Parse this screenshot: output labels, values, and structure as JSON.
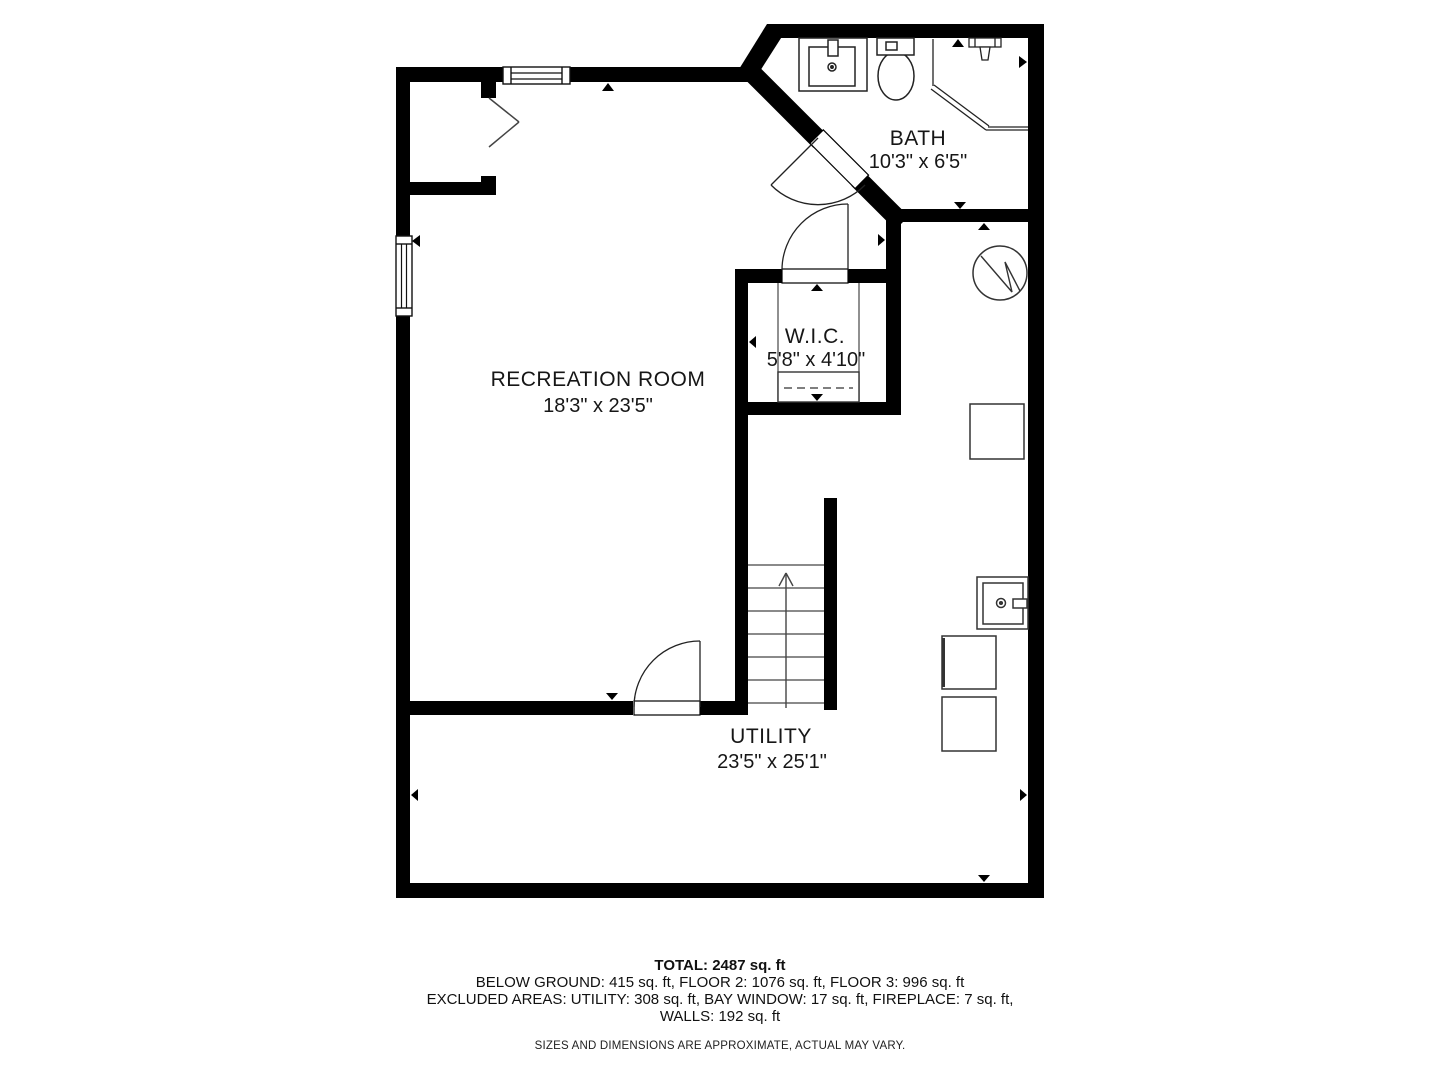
{
  "rooms": {
    "bath": {
      "name": "BATH",
      "dimensions": "10'3\" x 6'5\""
    },
    "wic": {
      "name": "W.I.C.",
      "dimensions": "5'8\" x 4'10\""
    },
    "recreation": {
      "name": "RECREATION ROOM",
      "dimensions": "18'3\" x 23'5\""
    },
    "utility": {
      "name": "UTILITY",
      "dimensions": "23'5\" x 25'1\""
    }
  },
  "fixtures": [
    "sink-vanity-icon",
    "toilet-icon",
    "shower-icon",
    "water-heater-icon",
    "appliance-icon",
    "laundry-sink-icon",
    "washer-icon",
    "dryer-icon",
    "stairs-up-icon",
    "fireplace-icon",
    "window-icon",
    "door-swing-icon",
    "closet-rod-icon",
    "dimension-arrow-icon"
  ],
  "summary": {
    "total": "TOTAL: 2487 sq. ft",
    "floors": "BELOW GROUND: 415 sq. ft, FLOOR 2: 1076 sq. ft, FLOOR 3: 996 sq. ft",
    "excluded": "EXCLUDED AREAS: UTILITY: 308 sq. ft, BAY WINDOW: 17 sq. ft, FIREPLACE: 7 sq. ft,",
    "excluded2": "WALLS: 192 sq. ft",
    "disclaimer": "SIZES AND DIMENSIONS ARE APPROXIMATE, ACTUAL MAY VARY."
  },
  "colors": {
    "wall": "#000000",
    "background": "#ffffff",
    "thin_line": "#333333"
  }
}
